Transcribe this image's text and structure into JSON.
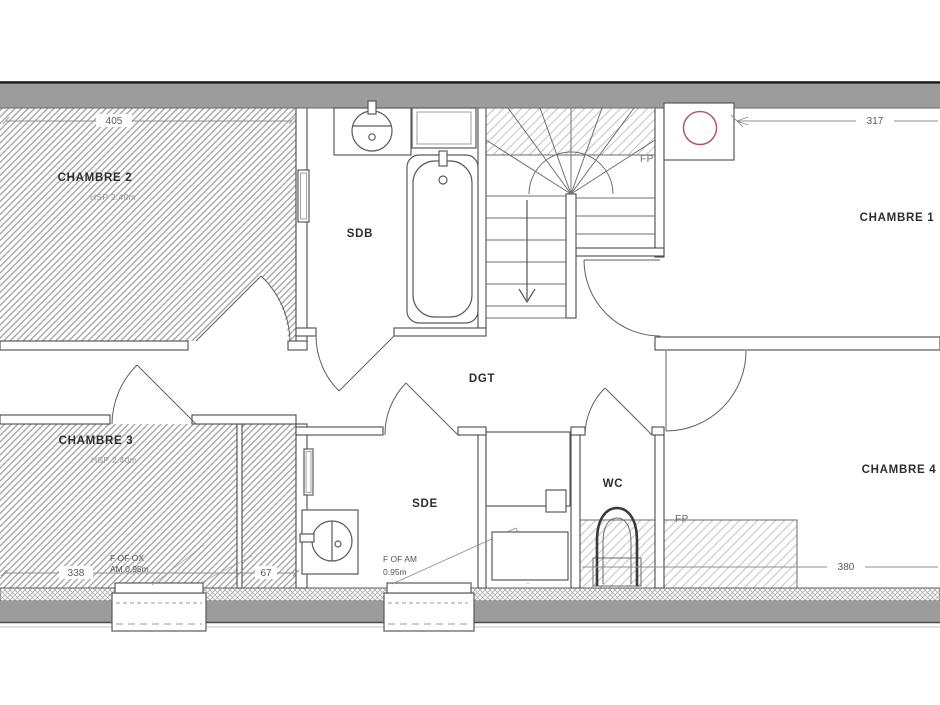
{
  "plan": {
    "type": "architectural-floor-plan",
    "floor": "upper floor (combles)",
    "rooms": [
      {
        "label": "CHAMBRE 2",
        "ceiling_height": "HSP 2.40m"
      },
      {
        "label": "CHAMBRE 1"
      },
      {
        "label": "CHAMBRE 3",
        "ceiling_height": "HSP 2.40m"
      },
      {
        "label": "CHAMBRE 4"
      },
      {
        "label": "SDB"
      },
      {
        "label": "SDE"
      },
      {
        "label": "WC"
      },
      {
        "label": "DGT"
      }
    ],
    "dimensions_cm": [
      {
        "value": "405",
        "edge": "top-left-room-width"
      },
      {
        "value": "317",
        "edge": "top-right-room-width"
      },
      {
        "value": "338",
        "edge": "bottom-left-room-width"
      },
      {
        "value": "67",
        "edge": "bottom-left-closet-width"
      },
      {
        "value": "380",
        "edge": "bottom-right-room-width"
      }
    ],
    "annotations": {
      "fp_stairs": "FP",
      "fp_right": "FP",
      "window_chambre3": {
        "line1": "F OF OX",
        "line2": "AM 0.95m"
      },
      "window_sde": {
        "line1": "F OF AM",
        "line2": "0.95m"
      }
    },
    "colors": {
      "wall_gray": "#9c9c9c",
      "flue_marker_red": "#b5566b",
      "room_hatch": "#ababab",
      "line": "#4a4a4a"
    }
  }
}
